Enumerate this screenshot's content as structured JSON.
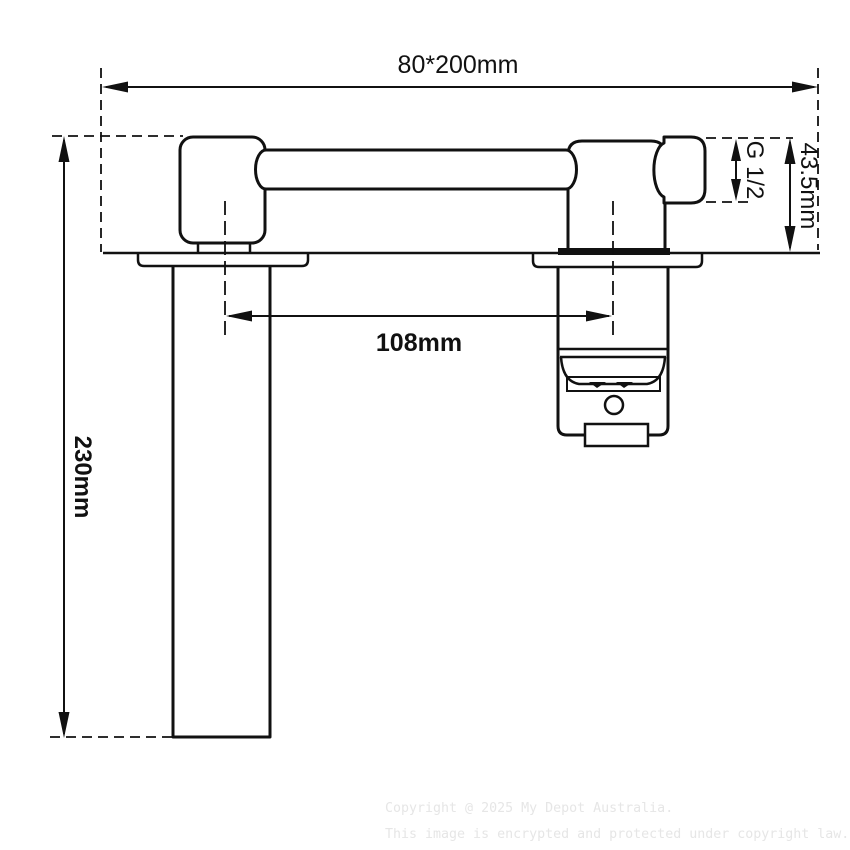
{
  "dimensions": {
    "overall_width": "80*200mm",
    "centre_distance": "108mm",
    "drop_height": "230mm",
    "body_height": "43.5mm",
    "thread_size": "G 1/2"
  },
  "watermark": {
    "line1": "Copyright @ 2025 My Depot Australia.",
    "line2": "This image is encrypted and protected under copyright law."
  },
  "colors": {
    "line": "#111111",
    "background": "#ffffff",
    "watermark": "#e6e6e6"
  }
}
